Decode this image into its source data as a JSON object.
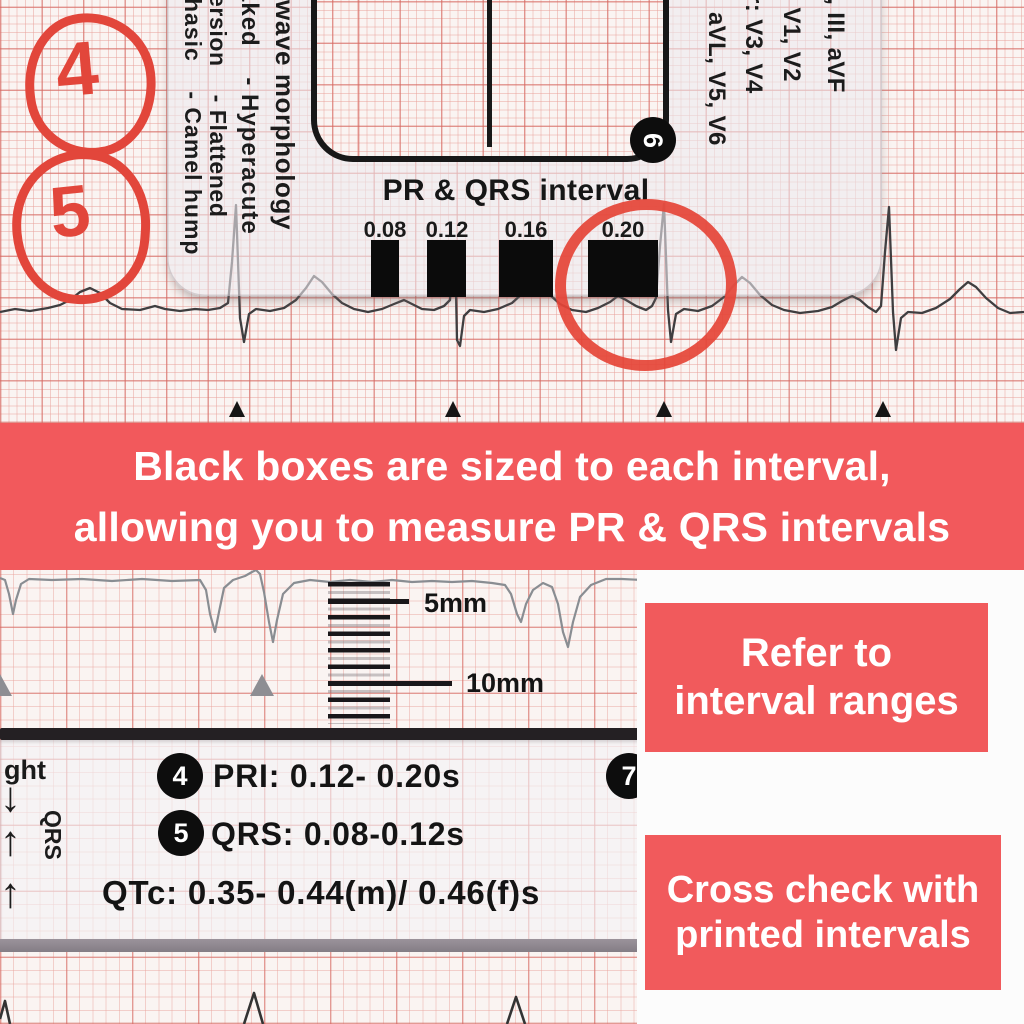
{
  "top": {
    "circle_labels": [
      "4",
      "5"
    ],
    "ruler": {
      "morphology_columns": [
        "wave morphology",
        "aked    - Hyperacute",
        "ersion    - Flattened",
        "hasic    - Camel hump"
      ],
      "lead_columns": [
        "II, III, aVF",
        ": V1, V2",
        "r: V3, V4",
        "aVL, V5, V6"
      ],
      "corner_badge": "6",
      "interval_title": "PR & QRS interval",
      "interval_values": [
        "0.08",
        "0.12",
        "0.16",
        "0.20"
      ],
      "highlighted_interval": "0.20"
    }
  },
  "banner": {
    "line1": "Black boxes are sized to each interval,",
    "line2": "allowing you to measure PR & QRS intervals"
  },
  "middle": {
    "scale_labels": {
      "five": "5mm",
      "ten": "10mm"
    },
    "rows": [
      {
        "badge": "4",
        "text": "PRI: 0.12- 0.20s"
      },
      {
        "badge": "5",
        "text": "QRS: 0.08-0.12s"
      },
      {
        "badge": "",
        "text": "QTc: 0.35- 0.44(m)/ 0.46(f)s"
      }
    ],
    "edge_badge": "7",
    "left_edge": {
      "fragment": "ght",
      "arrow_down": "↓",
      "arrow_up_1": "↑",
      "arrow_up_2": "↑",
      "vertical_label": "QRS"
    }
  },
  "notes": {
    "refer": {
      "line1": "Refer to",
      "line2": "interval ranges"
    },
    "cross": {
      "line1": "Cross check with",
      "line2": "printed intervals"
    }
  },
  "colors": {
    "banner_red": "#F2595C",
    "note_red": "#F15A5C",
    "marker_red": "#E54437",
    "hand_circle_red": "#E2463B",
    "grid_major": "#D4655E",
    "grid_minor": "#E8A19A",
    "print_black": "#151515"
  }
}
